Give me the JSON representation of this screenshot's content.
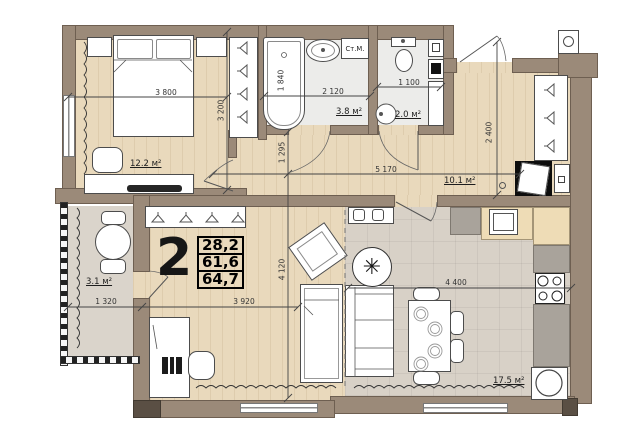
{
  "plan": {
    "apartment": {
      "rooms_number": "2",
      "living_area": "28,2",
      "apartment_area": "61,6",
      "total_area": "64,7"
    },
    "rooms": {
      "bedroom": {
        "area": "12.2 м²"
      },
      "bathroom": {
        "area": "3.8 м²"
      },
      "wc": {
        "area": "2.0 м²"
      },
      "hallway": {
        "area": "10.1 м²"
      },
      "balcony": {
        "area": "3.1 м²"
      },
      "kitchen_living": {
        "area": "17.5 м²"
      }
    },
    "labels": {
      "washing_machine": "Ст.М."
    },
    "dimensions": {
      "d3800": "3 800",
      "d3200": "3 200",
      "d1840": "1 840",
      "d2120": "2 120",
      "d1100": "1 100",
      "d2400": "2 400",
      "d1295": "1 295",
      "d5170": "5 170",
      "d4120": "4 120",
      "d3920": "3 920",
      "d1320": "1 320",
      "d4400": "4 400"
    },
    "icons": {
      "plant": "✳"
    },
    "colors": {
      "wall": "#9b8a79",
      "wood_floor": "#e9d9bc",
      "tile_floor": "#ececea",
      "kitchen_floor": "#d8d1c7",
      "balcony_floor": "#dad4cb"
    }
  }
}
